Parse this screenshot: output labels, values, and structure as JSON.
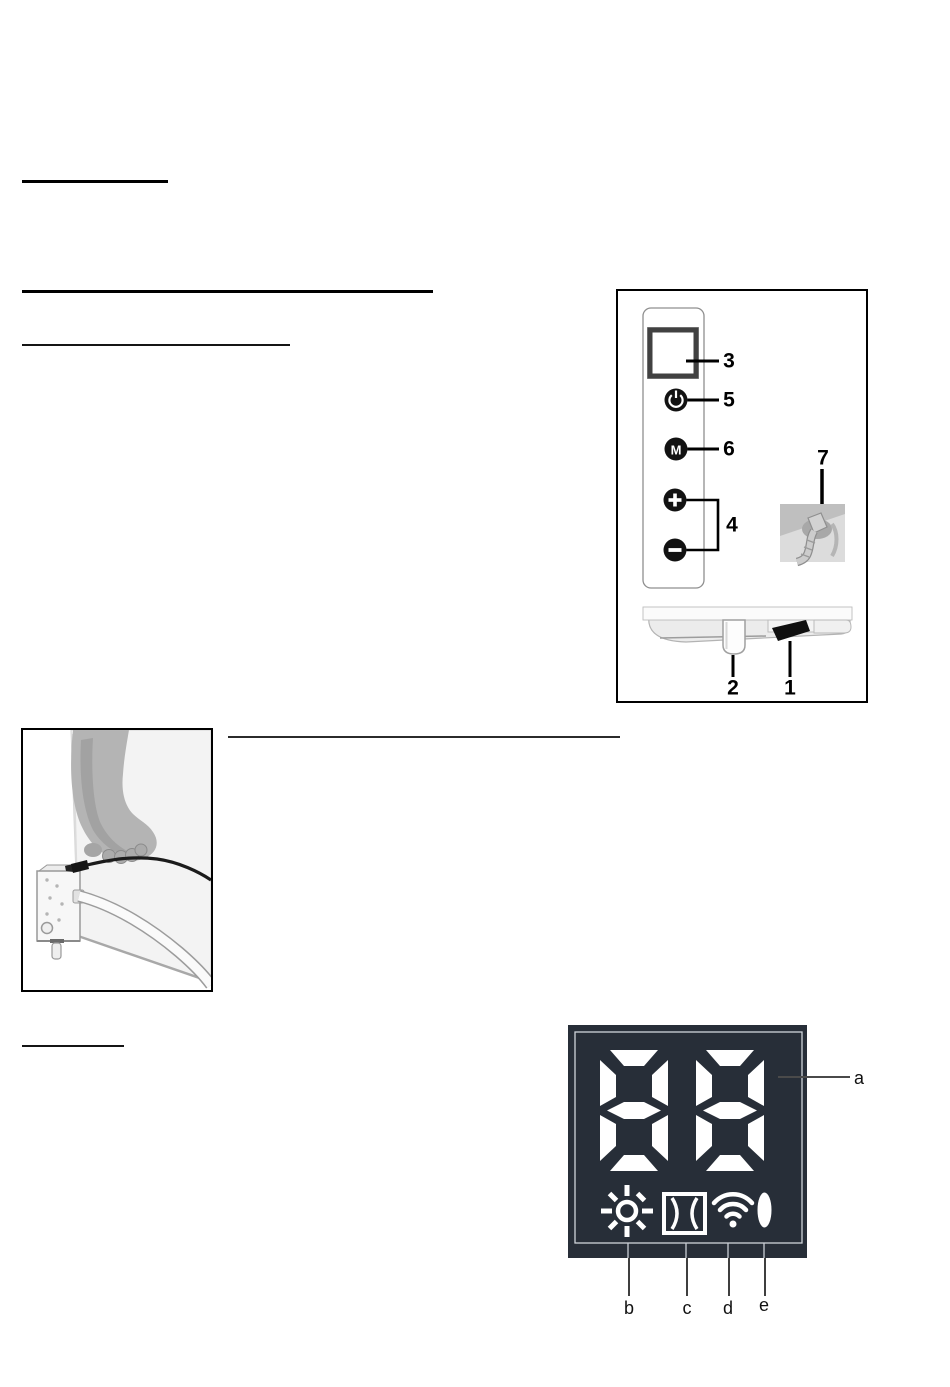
{
  "control_panel": {
    "callouts": {
      "display_screen": "3",
      "power_button": "5",
      "mode_button": "6",
      "plus_minus_buttons": "4",
      "power_plug": "7",
      "thermostat_knob": "2",
      "power_switch": "1"
    },
    "mode_button_label": "M"
  },
  "led_display": {
    "value": "88",
    "panel_color": "#272e38",
    "segment_color": "#ffffff",
    "callouts": {
      "digit_display": "a",
      "heating_icon": "b",
      "open_window_icon": "c",
      "wifi_icon": "d",
      "power_indicator_icon": "e"
    }
  }
}
